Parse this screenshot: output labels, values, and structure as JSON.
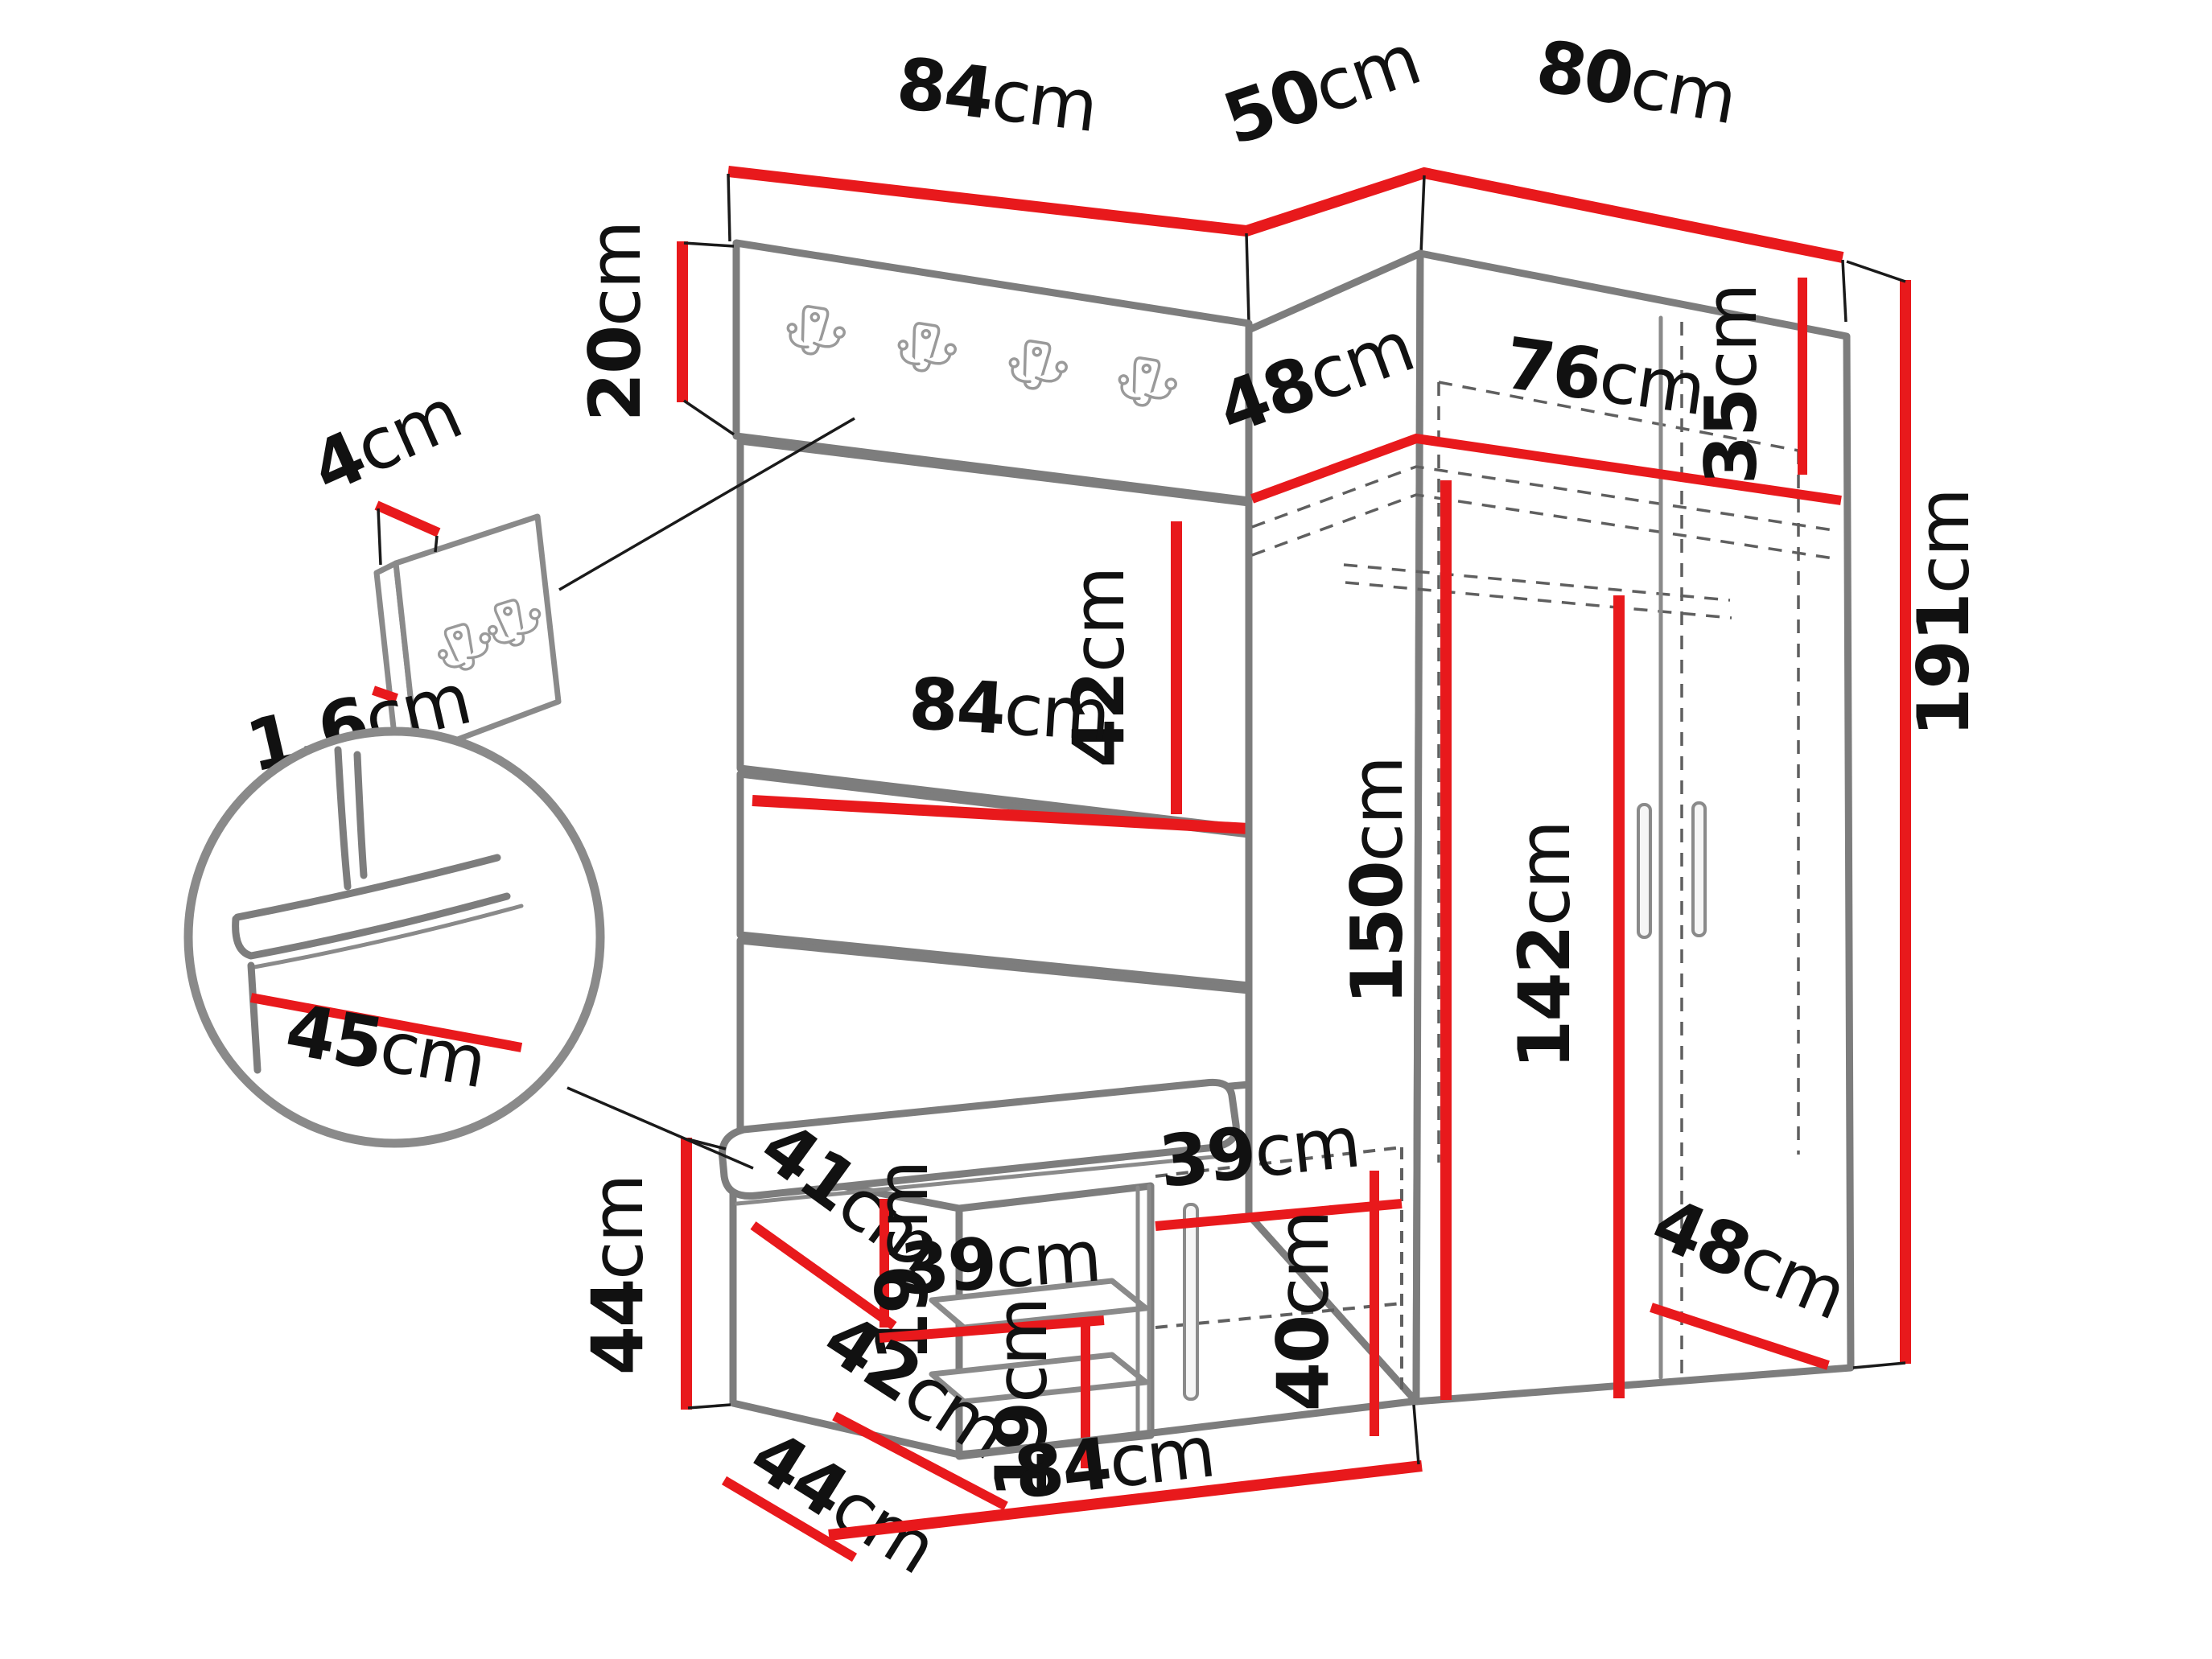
{
  "figure": {
    "kind": "furniture-dimension-diagram",
    "unit": "cm"
  },
  "colors": {
    "dimension_line": "#e8191c",
    "furniture_outline": "#7d7d7d",
    "label_text": "#111111",
    "background": "#ffffff"
  },
  "dims": {
    "hook_panel_width": {
      "v": "84",
      "u": "cm"
    },
    "corner_gap": {
      "v": "50",
      "u": "cm"
    },
    "wardrobe_width": {
      "v": "80",
      "u": "cm"
    },
    "hook_strip_height": {
      "v": "20",
      "u": "cm"
    },
    "mini_panel_width": {
      "v": "4",
      "u": "cm"
    },
    "mini_panel_thickness": {
      "v": "1,6",
      "u": "cm"
    },
    "cushion_height": {
      "v": "42",
      "u": "cm"
    },
    "panel_width_mid": {
      "v": "84",
      "u": "cm"
    },
    "wardrobe_depth_top": {
      "v": "48",
      "u": "cm"
    },
    "wardrobe_inner_width": {
      "v": "76",
      "u": "cm"
    },
    "top_shelf_height": {
      "v": "35",
      "u": "cm"
    },
    "inner_height": {
      "v": "150",
      "u": "cm"
    },
    "door_height": {
      "v": "142",
      "u": "cm"
    },
    "total_height": {
      "v": "191",
      "u": "cm"
    },
    "seat_depth": {
      "v": "45",
      "u": "cm"
    },
    "bench_height": {
      "v": "44",
      "u": "cm"
    },
    "bench_shelf_depth_top": {
      "v": "41",
      "u": "cm"
    },
    "bench_gap_upper": {
      "v": "19",
      "u": "cm"
    },
    "bench_shelf_width": {
      "v": "39",
      "u": "cm"
    },
    "bench_shelf_depth_bot": {
      "v": "42",
      "u": "cm"
    },
    "bench_gap_lower": {
      "v": "19",
      "u": "cm"
    },
    "bench_door_width": {
      "v": "39",
      "u": "cm"
    },
    "bench_door_height": {
      "v": "40",
      "u": "cm"
    },
    "bench_depth": {
      "v": "44",
      "u": "cm"
    },
    "bench_width": {
      "v": "84",
      "u": "cm"
    },
    "wardrobe_depth_bottom": {
      "v": "48",
      "u": "cm"
    }
  }
}
